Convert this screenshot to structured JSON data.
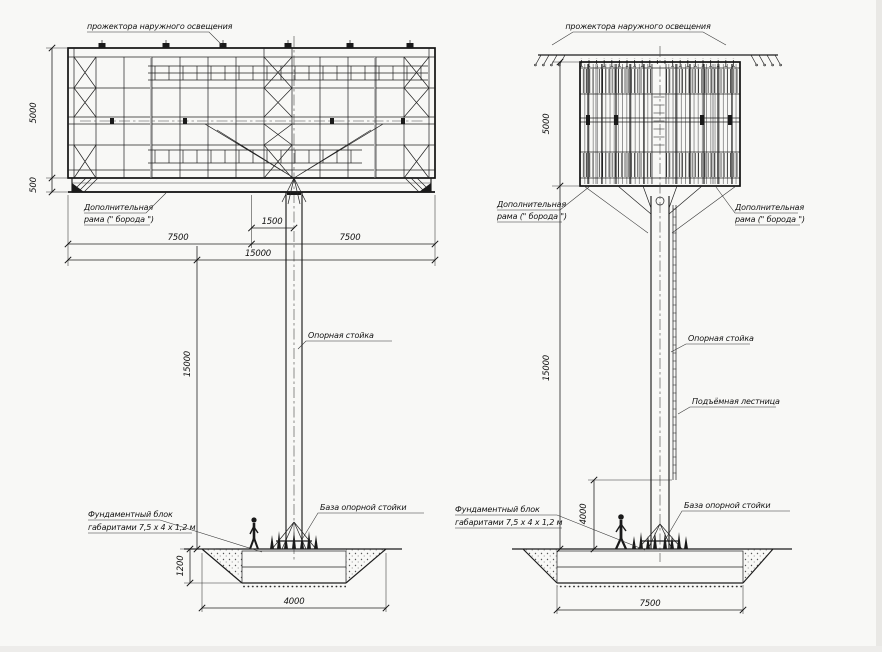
{
  "drawing": {
    "ink_color": "#1f1f1f",
    "paper_color": "#f8f8f6",
    "front_view": {
      "floodlights_label": "прожектора наружного освещения",
      "extra_frame_label_1": "Дополнительная",
      "extra_frame_label_2": "рама (\" борода \")",
      "support_post_label": "Опорная стойка",
      "foundation_label_1": "Фундаментный блок",
      "foundation_label_2": "габаритами  7,5 х 4 х 1,2 м",
      "post_base_label": "База опорной стойки",
      "dim_panel_height": "5000",
      "dim_skirt_height": "500",
      "dim_left_half": "7500",
      "dim_offset": "1500",
      "dim_right_half": "7500",
      "dim_total_width": "15000",
      "dim_post_height": "15000",
      "dim_foundation_depth": "1200",
      "dim_pit_width": "4000"
    },
    "side_view": {
      "floodlights_label": "прожектора наружного освещения",
      "extra_frame_left_1": "Дополнительная",
      "extra_frame_left_2": "рама (\" борода \")",
      "extra_frame_right_1": "Дополнительная",
      "extra_frame_right_2": "рама (\" борода \")",
      "support_post_label": "Опорная стойка",
      "ladder_label": "Подъёмная лестница",
      "foundation_label_1": "Фундаментный блок",
      "foundation_label_2": "габаритами  7,5 х 4 х 1,2 м",
      "post_base_label": "База опорной стойки",
      "dim_panel_height": "5000",
      "dim_post_height": "15000",
      "dim_ladder_clearance": "4000",
      "dim_foundation_width": "7500"
    }
  }
}
